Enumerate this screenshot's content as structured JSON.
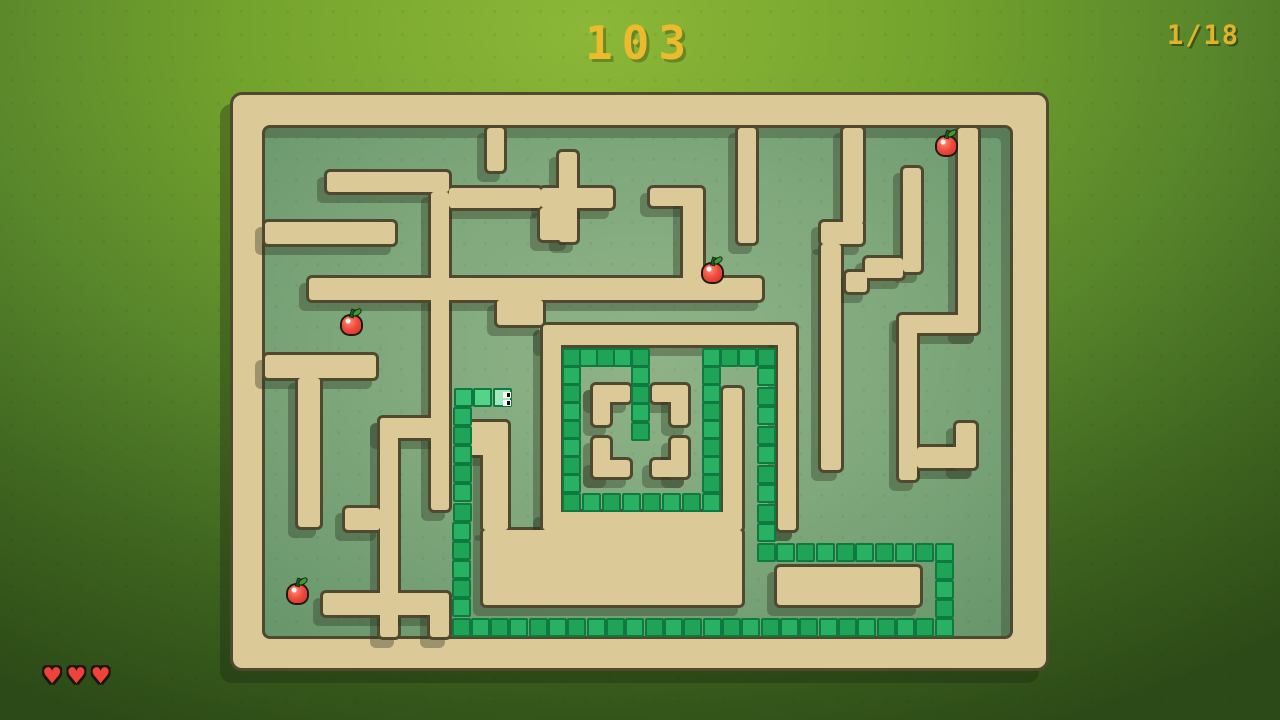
{
  "hud": {
    "score": "103",
    "level_indicator": "1/18",
    "lives": 3,
    "heart_icon": "♥",
    "colors": {
      "score_text": "#ECBA2D",
      "heart": "#ED4338"
    }
  },
  "maze": {
    "frame": [
      233,
      95,
      813,
      573
    ],
    "floor": [
      265,
      128,
      745,
      508
    ],
    "colors": {
      "wall": "#DCC998",
      "wall_outline": "#4F4A2F",
      "wall_shadow": "rgba(43,53,32,0.36)",
      "floor_center": "#90B388",
      "floor_edge": "#45724C",
      "background_light": "#8CB838",
      "background_dark": "#2C4A17"
    },
    "walls": [
      [
        487,
        128,
        17,
        43
      ],
      [
        327,
        172,
        122,
        20
      ],
      [
        431,
        192,
        18,
        318
      ],
      [
        449,
        188,
        92,
        20
      ],
      [
        559,
        152,
        18,
        90
      ],
      [
        541,
        188,
        72,
        20
      ],
      [
        540,
        208,
        30,
        32
      ],
      [
        650,
        188,
        53,
        18
      ],
      [
        683,
        188,
        20,
        95
      ],
      [
        309,
        278,
        453,
        22
      ],
      [
        497,
        300,
        46,
        25
      ],
      [
        738,
        128,
        18,
        115
      ],
      [
        843,
        128,
        20,
        96
      ],
      [
        821,
        222,
        42,
        22
      ],
      [
        821,
        244,
        20,
        226
      ],
      [
        903,
        168,
        18,
        104
      ],
      [
        865,
        258,
        38,
        20
      ],
      [
        846,
        272,
        21,
        20
      ],
      [
        958,
        128,
        20,
        205
      ],
      [
        902,
        315,
        76,
        18
      ],
      [
        899,
        315,
        18,
        165
      ],
      [
        917,
        447,
        58,
        21
      ],
      [
        956,
        423,
        20,
        45
      ],
      [
        265,
        222,
        130,
        22
      ],
      [
        265,
        355,
        111,
        23
      ],
      [
        298,
        378,
        22,
        149
      ],
      [
        380,
        418,
        69,
        20
      ],
      [
        380,
        418,
        18,
        219
      ],
      [
        345,
        508,
        35,
        22
      ],
      [
        323,
        593,
        126,
        22
      ],
      [
        430,
        593,
        19,
        44
      ],
      [
        470,
        422,
        38,
        33
      ],
      [
        483,
        422,
        25,
        108
      ],
      [
        483,
        530,
        259,
        75
      ],
      [
        777,
        567,
        143,
        38
      ],
      [
        543,
        325,
        253,
        20
      ],
      [
        543,
        325,
        18,
        205
      ],
      [
        778,
        325,
        18,
        205
      ],
      [
        543,
        512,
        199,
        18
      ],
      [
        778,
        512,
        18,
        18
      ],
      [
        723,
        388,
        19,
        142
      ],
      [
        593,
        385,
        37,
        17
      ],
      [
        593,
        385,
        17,
        40
      ],
      [
        652,
        385,
        36,
        17
      ],
      [
        671,
        385,
        17,
        40
      ],
      [
        593,
        460,
        37,
        17
      ],
      [
        593,
        438,
        17,
        39
      ],
      [
        652,
        460,
        36,
        17
      ],
      [
        671,
        438,
        17,
        39
      ]
    ]
  },
  "snake": {
    "cell_size": 19.33,
    "head_direction": "right",
    "colors": {
      "head": "#9FE8BB",
      "neck_1": "#55D38B",
      "neck_2": "#36BE71",
      "body_even": "#1FA356",
      "body_odd": "#29B163",
      "border": "#0E7A40"
    },
    "path_waypoints": [
      [
        502,
        397
      ],
      [
        463,
        397
      ],
      [
        461,
        627
      ],
      [
        944,
        627
      ],
      [
        944,
        552
      ],
      [
        766,
        552
      ],
      [
        766,
        357
      ],
      [
        711,
        357
      ],
      [
        711,
        502
      ],
      [
        571,
        502
      ],
      [
        571,
        357
      ],
      [
        640,
        357
      ],
      [
        640,
        431
      ]
    ]
  },
  "apples": [
    [
      351,
      324
    ],
    [
      297,
      593
    ],
    [
      712,
      272
    ],
    [
      946,
      145
    ]
  ]
}
